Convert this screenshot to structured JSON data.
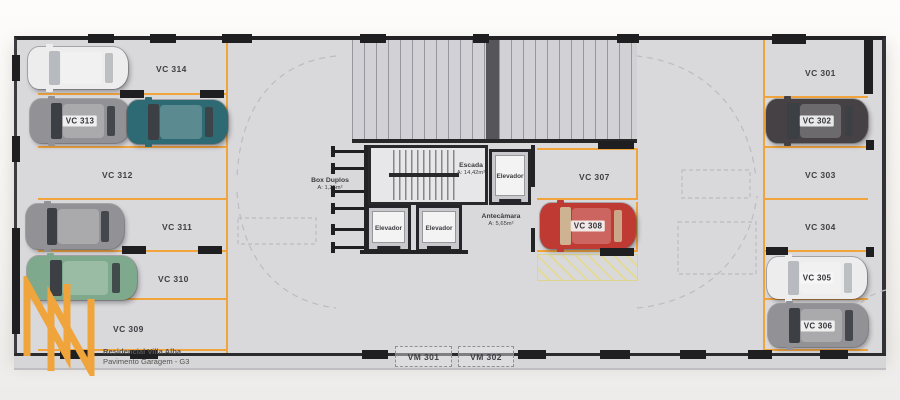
{
  "title": {
    "line1": "Residencial Villa Alba",
    "line2": "Pavimento Garagem - G3"
  },
  "colors": {
    "accent_orange": "#F2A43C",
    "floor": "#D9D9DC",
    "wall": "#232326",
    "hatch_yellow": "#E2DA96",
    "car_white": "#EDEDEE",
    "car_gray": "#929296",
    "car_teal": "#2E6A73",
    "car_green": "#7EA98C",
    "car_dark": "#454144",
    "car_red": "#BE3A32",
    "glass_dark": "#3C4045",
    "glass_light": "#B7BABE",
    "glass_tan": "#CDB392"
  },
  "left_spots": [
    {
      "id": "VC 314",
      "car": "white"
    },
    {
      "id": "VC 313",
      "car": "gray",
      "car2": "teal"
    },
    {
      "id": "VC 312",
      "car": null
    },
    {
      "id": "VC 311",
      "car": "gray"
    },
    {
      "id": "VC 310",
      "car": "green"
    },
    {
      "id": "VC 309",
      "car": null
    }
  ],
  "right_spots": [
    {
      "id": "VC 301",
      "car": null
    },
    {
      "id": "VC 302",
      "car": "dark"
    },
    {
      "id": "VC 303",
      "car": null
    },
    {
      "id": "VC 304",
      "car": null
    },
    {
      "id": "VC 305",
      "car": "white"
    },
    {
      "id": "VC 306",
      "car": "gray"
    }
  ],
  "center_spots": [
    {
      "id": "VC 307",
      "car": null
    },
    {
      "id": "VC 308",
      "car": "red"
    }
  ],
  "moto_spots": [
    {
      "id": "VM 301"
    },
    {
      "id": "VM 302"
    }
  ],
  "rooms": {
    "stairs": {
      "label": "Escada",
      "area": "A: 14,42m²"
    },
    "elevator": {
      "label": "Elevador"
    },
    "antechamber": {
      "label": "Antecâmara",
      "area": "A: 5,65m²"
    },
    "double_box": {
      "label": "Box Duplos",
      "area": "A: 1,25m²"
    }
  }
}
